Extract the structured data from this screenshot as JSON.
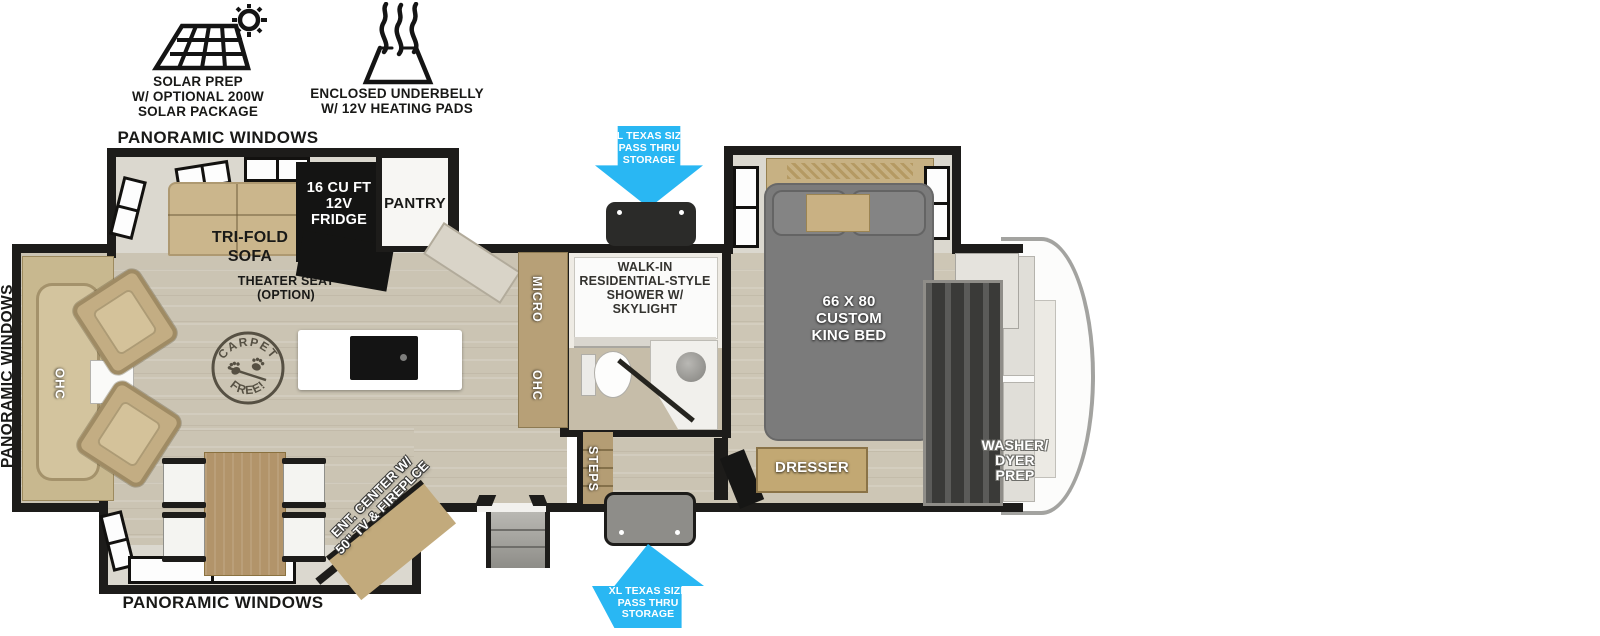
{
  "colors": {
    "accent_blue": "#29B7F3",
    "wall": "#1D1C1A",
    "floor_wood": "#CBC4B3",
    "cabinet_tan": "#C2AC82",
    "bed_gray": "#7B7B7B"
  },
  "header": {
    "solar_label": "SOLAR PREP\nW/ OPTIONAL 200W\nSOLAR PACKAGE",
    "underbelly_label": "ENCLOSED UNDERBELLY\nW/ 12V HEATING PADS"
  },
  "exterior": {
    "panoramic_top": "PANORAMIC WINDOWS",
    "panoramic_left": "PANORAMIC WINDOWS",
    "panoramic_bottom": "PANORAMIC WINDOWS",
    "pass_thru_top": "XL TEXAS SIZE\nPASS THRU\nSTORAGE",
    "pass_thru_bottom": "XL TEXAS SIZE\nPASS THRU\nSTORAGE"
  },
  "living": {
    "sofa": "TRI-FOLD\nSOFA",
    "theater_seat": "THEATER SEAT\n(OPTION)",
    "rear_ohc": "OHC",
    "stamp_top": "CARPET",
    "stamp_bottom": "FREE!",
    "ent_center": "ENT. CENTER W/\n50\" TV & FIREPLCE"
  },
  "kitchen": {
    "fridge": "16 CU FT\n12V\nFRIDGE",
    "pantry": "PANTRY",
    "micro": "MICRO",
    "ohc": "OHC"
  },
  "bathroom": {
    "shower": "WALK-IN\nRESIDENTIAL-STYLE\nSHOWER W/\nSKYLIGHT",
    "steps": "STEPS"
  },
  "bedroom": {
    "bed": "66 X 80\nCUSTOM\nKING BED",
    "dresser": "DRESSER",
    "washer_prep": "WASHER/\nDYER\nPREP"
  }
}
